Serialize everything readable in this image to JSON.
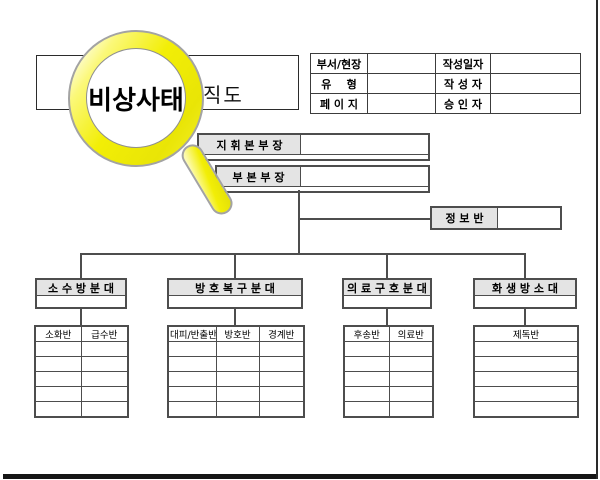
{
  "colors": {
    "accent_yellow": "#f2ee06",
    "cell_gray": "#e4e4e4",
    "line_gray": "#4d4d4d",
    "bar_black": "#151515"
  },
  "magnifier": {
    "label": "비상사태"
  },
  "title": {
    "visible_text": "직도"
  },
  "meta_table": {
    "rows": [
      [
        "부서/현장",
        "",
        "작성일자",
        ""
      ],
      [
        "유    형",
        "",
        "작 성 자",
        ""
      ],
      [
        "페 이 지",
        "",
        "승 인 자",
        ""
      ]
    ]
  },
  "org_chart": {
    "commander": "지 휘 본 부 장",
    "deputy": "부 본 부 장",
    "staff_team": "정 보 반",
    "divisions": [
      {
        "name": "소 수 방 분 대",
        "teams": [
          "소화반",
          "급수반"
        ],
        "empty_rows": 5
      },
      {
        "name": "방 호 복 구 분 대",
        "teams": [
          "대피/반출반",
          "방호반",
          "경계반"
        ],
        "empty_rows": 5
      },
      {
        "name": "의 료 구 호 분 대",
        "teams": [
          "후송반",
          "의료반"
        ],
        "empty_rows": 5
      },
      {
        "name": "화 생 방 소 대",
        "teams": [
          "제독반"
        ],
        "empty_rows": 5
      }
    ]
  }
}
